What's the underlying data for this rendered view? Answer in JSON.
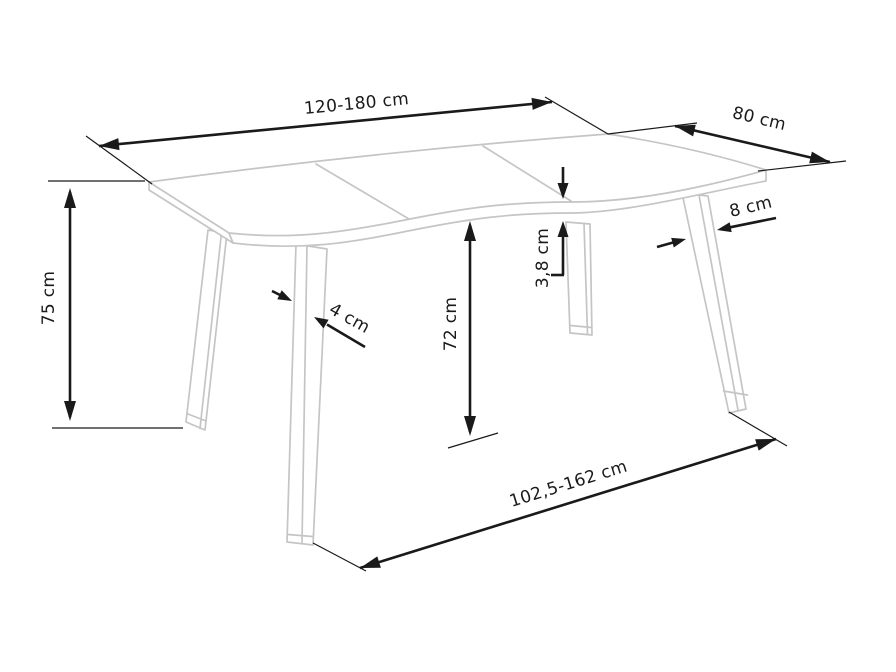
{
  "diagram": {
    "kind": "table-dimension-drawing",
    "colors": {
      "table_outline": "#c5c5c5",
      "dimension": "#1a1a1a",
      "background": "#ffffff"
    },
    "dimensions": {
      "table_length": {
        "label": "120-180 cm"
      },
      "table_depth": {
        "label": "80 cm"
      },
      "table_height": {
        "label": "75 cm"
      },
      "leg_thickness": {
        "label": "4 cm"
      },
      "underside_clearance": {
        "label": "72 cm"
      },
      "top_thickness": {
        "label": "3,8 cm"
      },
      "leg_width": {
        "label": "8 cm"
      },
      "leg_span": {
        "label": "102,5-162 cm"
      }
    }
  }
}
